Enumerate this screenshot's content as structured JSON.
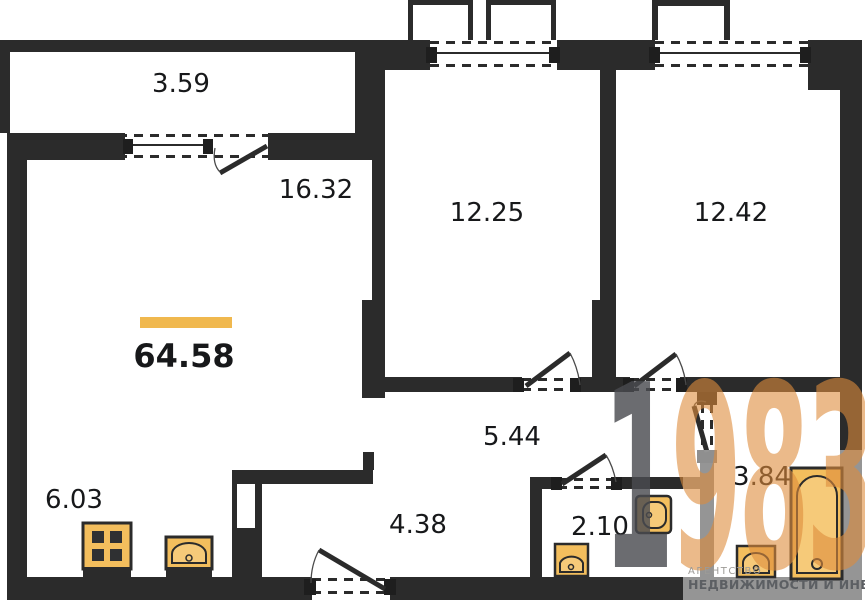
{
  "plan": {
    "total_area": "64.58",
    "rooms": {
      "balcony": {
        "area": "3.59"
      },
      "living": {
        "area": "16.32"
      },
      "bedroom1": {
        "area": "12.25"
      },
      "bedroom2": {
        "area": "12.42"
      },
      "corridor": {
        "area": "5.44"
      },
      "kitchen": {
        "area": "6.03"
      },
      "hall": {
        "area": "4.38"
      },
      "wc": {
        "area": "2.10"
      },
      "bathroom": {
        "area": "3.84"
      }
    },
    "fixtures": {
      "kitchen": [
        "stove-icon",
        "kitchen-sink-icon"
      ],
      "wc": [
        "toilet-icon",
        "wc-sink-icon"
      ],
      "bathroom": [
        "bathtub-icon",
        "bathroom-sink-icon"
      ]
    }
  },
  "branding": {
    "logo_digit_dark": "1",
    "logo_digits_orange": "983",
    "tagline_line1": "АГЕНТСТВО",
    "tagline_line2": "НЕДВИЖИМОСТИ И ИНВЕСТИЦИЙ"
  },
  "colors": {
    "wall": "#2b2b2b",
    "fixture_fill": "#f3be5d",
    "fixture_fill_light": "#f6ca79",
    "accent_bar": "#f0b84e",
    "logo_orange": "#dd8c3c",
    "logo_dark": "#4b4c50"
  }
}
